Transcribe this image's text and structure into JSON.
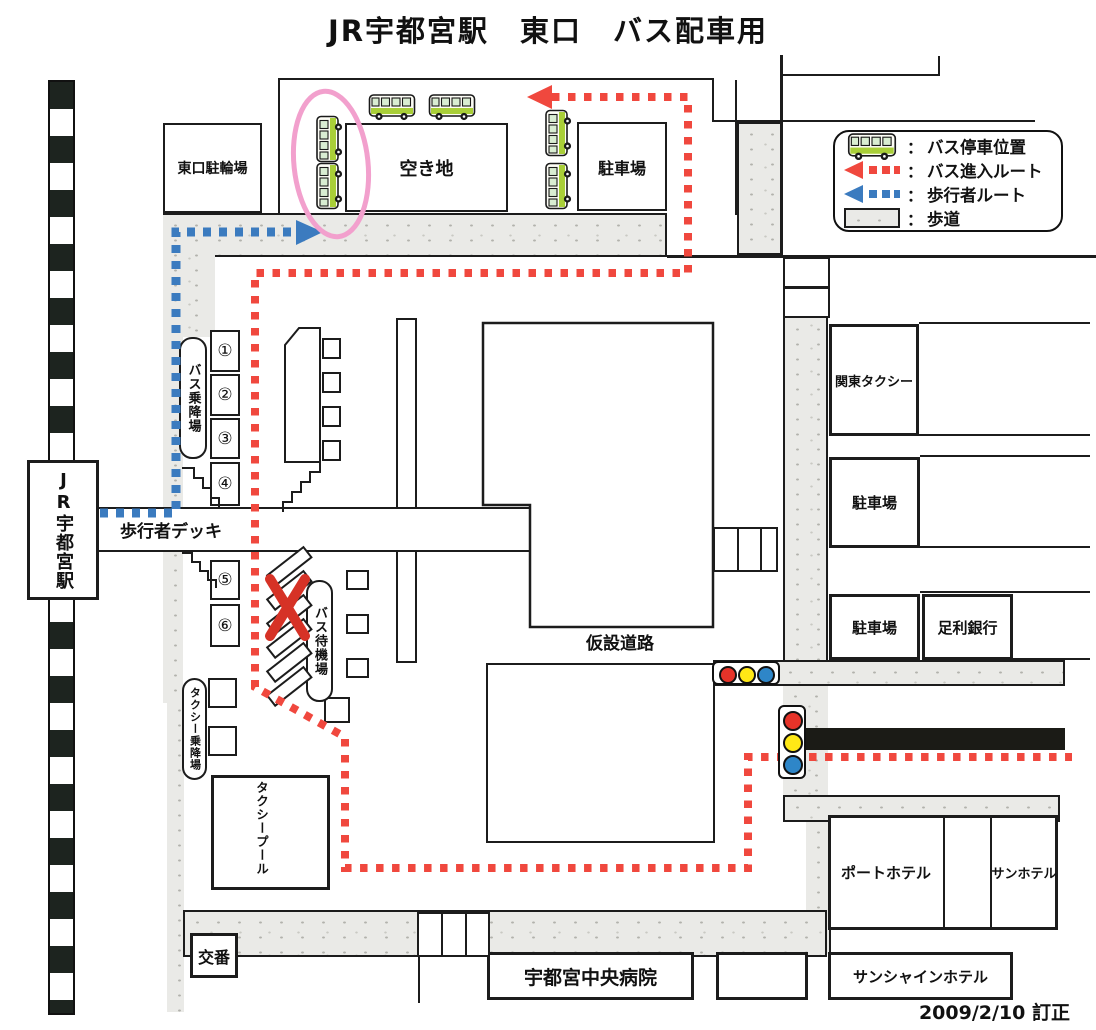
{
  "title": "JR宇都宮駅　東口　バス配車用",
  "revision_date": "2009/2/10 訂正",
  "legend": {
    "rows": [
      {
        "icon": "bus-icon",
        "separator": "：",
        "label": "バス停車位置"
      },
      {
        "icon": "bus-route-arrow-icon",
        "separator": "：",
        "label": "バス進入ルート"
      },
      {
        "icon": "pedestrian-route-arrow-icon",
        "separator": "：",
        "label": "歩行者ルート"
      },
      {
        "icon": "sidewalk-swatch",
        "separator": "：",
        "label": "歩道"
      }
    ]
  },
  "station": {
    "label": "JR宇都宮駅"
  },
  "areas": {
    "bicycle_parking": "東口駐輪場",
    "vacant_lot": "空き地",
    "parking_top": "駐車場",
    "bus_boarding": "バス乗降場",
    "general_car_boarding": "一般車乗降場",
    "pedestrian_deck": "歩行者デッキ",
    "bus_waiting": "バス待機場",
    "taxi_boarding": "タクシー乗降場",
    "taxi_pool": "タクシープール",
    "police_box": "交番",
    "temporary_road": "仮設道路",
    "kanto_taxi": "関東タクシー",
    "parking_mid": "駐車場",
    "parking_low": "駐車場",
    "ashikaga_bank": "足利銀行",
    "port_hotel": "ポートホテル",
    "sun_hotel": "サンホテル",
    "sunshine_hotel": "サンシャインホテル",
    "central_hospital": "宇都宮中央病院"
  },
  "bus_stop_numbers": [
    "①",
    "②",
    "③",
    "④",
    "⑤",
    "⑥"
  ],
  "colors": {
    "bus_route": "#f0483e",
    "pedestrian_route": "#3b7bbf",
    "sidewalk": "#eaeae7",
    "highlight_circle": "#f2a0cd",
    "cross_mark": "#d63226",
    "signal_red": "#e63329",
    "signal_yellow": "#ffe816",
    "signal_blue": "#2e86c8",
    "bus_body_green": "#a9cf38"
  }
}
